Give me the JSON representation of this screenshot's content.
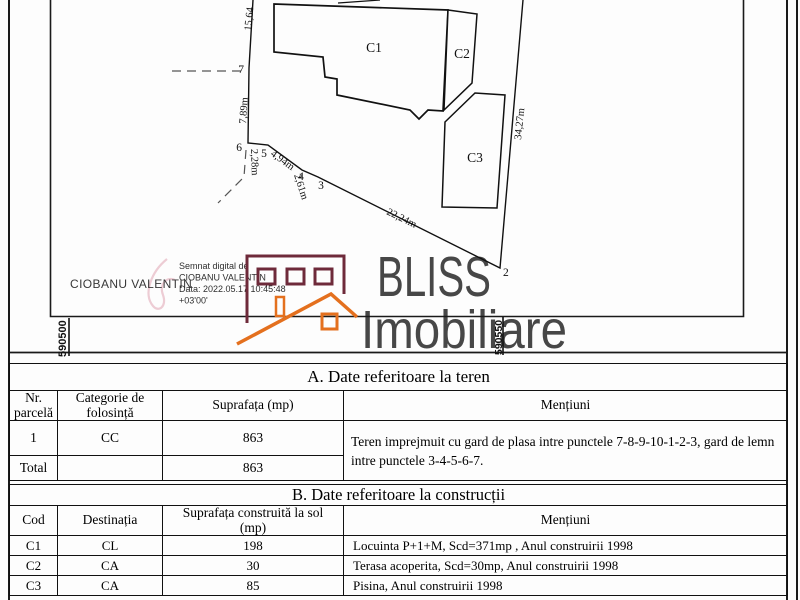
{
  "plan": {
    "buildings": {
      "c1": "C1",
      "c2": "C2",
      "c3": "C3"
    },
    "points": {
      "p2": "2",
      "p3": "3",
      "p4": "4",
      "p5": "5",
      "p6": "6",
      "p7": "7"
    },
    "measurements": {
      "seg_top": "15,64",
      "seg_7_6": "7,89m",
      "seg_6_5": "2,28m",
      "seg_5_4": "4,94m",
      "seg_4_3": "2,61m",
      "seg_3_2": "22,24m",
      "seg_right": "34,27m"
    },
    "grid": {
      "x_left": "590500",
      "x_right": "590550"
    },
    "signature": {
      "name": "CIOBANU VALENTIN",
      "stamp_lines": [
        "Semnat digital de",
        "CIOBANU VALENTIN",
        "Data: 2022.05.17 10:45:48",
        "+03'00'"
      ]
    },
    "watermark": {
      "brand": "BLISS",
      "subtitle": "Imobiliare"
    }
  },
  "table_a": {
    "title": "A. Date referitoare la teren",
    "headers": {
      "col1": [
        "Nr.",
        "parcelă"
      ],
      "col2": [
        "Categorie de",
        "folosință"
      ],
      "col3": "Suprafața (mp)",
      "col4": "Mențiuni"
    },
    "row1": {
      "nr": "1",
      "categorie": "CC",
      "suprafata": "863"
    },
    "total": {
      "label": "Total",
      "suprafata": "863"
    },
    "mentiuni": "Teren imprejmuit cu gard de plasa intre punctele 7-8-9-10-1-2-3, gard de lemn intre punctele 3-4-5-6-7."
  },
  "table_b": {
    "title": "B. Date referitoare la construcții",
    "headers": {
      "col1": "Cod",
      "col2": "Destinația",
      "col3": [
        "Suprafața construită la sol",
        "(mp)"
      ],
      "col4": "Mențiuni"
    },
    "rows": [
      {
        "cod": "C1",
        "destinatia": "CL",
        "suprafata": "198",
        "mentiuni": "Locuinta P+1+M, Scd=371mp , Anul construirii 1998"
      },
      {
        "cod": "C2",
        "destinatia": "CA",
        "suprafata": "30",
        "mentiuni": "Terasa acoperita, Scd=30mp, Anul construirii 1998"
      },
      {
        "cod": "C3",
        "destinatia": "CA",
        "suprafata": "85",
        "mentiuni": "Pisina, Anul construirii 1998"
      }
    ]
  },
  "colors": {
    "ink": "#1a1a1a",
    "logo_maroon": "#6e2a3a",
    "logo_orange": "#e4701e",
    "watermark_gray": "#3e3e3e",
    "signature_pink": "#eac3cc"
  }
}
